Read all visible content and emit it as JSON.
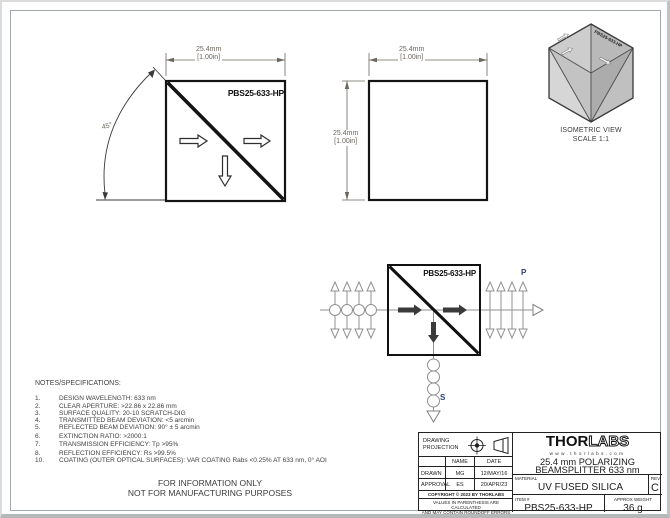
{
  "drawing": {
    "part_number": "PBS25-633-HP",
    "dim_mm": "25.4mm",
    "dim_in": "[1.00in]",
    "angle": "45°"
  },
  "isometric": {
    "part_label": "PBS25-633-HP",
    "caption": "ISOMETRIC VIEW",
    "scale": "SCALE 1:1"
  },
  "beam": {
    "part_label": "PBS25-633-HP",
    "p": "P",
    "s": "S",
    "label_color": "#27407c"
  },
  "notes": {
    "heading": "NOTES/SPECIFICATIONS:",
    "items": [
      {
        "num": "1.",
        "text": "DESIGN WAVELENGTH: 633 nm"
      },
      {
        "num": "2.",
        "text": "CLEAR APERTURE: >22.86 x 22.86 mm"
      },
      {
        "num": "3.",
        "text": "SURFACE QUALITY: 20-10 SCRATCH-DIG"
      },
      {
        "num": "4.",
        "text": "TRANSMITTED BEAM DEVIATION: <5 arcmin"
      },
      {
        "num": "5.",
        "text": "REFLECTED BEAM DEVIATION: 90° ± 5 arcmin"
      },
      {
        "num": "6.",
        "text": "EXTINCTION RATIO: >2000:1"
      },
      {
        "num": "7.",
        "text": "TRANSMISSION EFFICIENCY: Tp >95%"
      },
      {
        "num": "8.",
        "text": "REFLECTION EFFICIENCY: Rs >99.5%"
      },
      {
        "num": "10.",
        "text": "COATING (OUTER OPTICAL SURFACES): VAR COATING Rabs <0.25% AT 633 nm, 0° AOI"
      }
    ]
  },
  "notice": {
    "line1": "FOR INFORMATION ONLY",
    "line2": "NOT FOR MANUFACTURING PURPOSES"
  },
  "title_block": {
    "projection_line1": "DRAWING",
    "projection_line2": "PROJECTION",
    "col_name": "NAME",
    "col_date": "DATE",
    "row_drawn_label": "DRAWN",
    "row_drawn_name": "MG",
    "row_drawn_date": "12/MAY/16",
    "row_approval_label": "APPROVAL",
    "row_approval_name": "ES",
    "row_approval_date": "20/APR/23",
    "copyright": "COPYRIGHT © 2023 BY THORLABS",
    "disclaimer1": "VALUES IN PARENTHESIS ARE CALCULATED",
    "disclaimer2": "AND MAY CONTAIN ROUNDOFF ERRORS",
    "logo_thor": "THOR",
    "logo_labs": "LABS",
    "website": "www.thorlabs.com",
    "title1": "25.4 mm POLARIZING",
    "title2": "BEAMSPLITTER 633 nm",
    "material_label": "MATERIAL",
    "material": "UV FUSED SILICA",
    "rev_label": "REV",
    "rev": "C",
    "item_label": "ITEM #",
    "item": "PBS25-633-HP",
    "weight_label": "APPROX WEIGHT",
    "weight": "36 g"
  }
}
